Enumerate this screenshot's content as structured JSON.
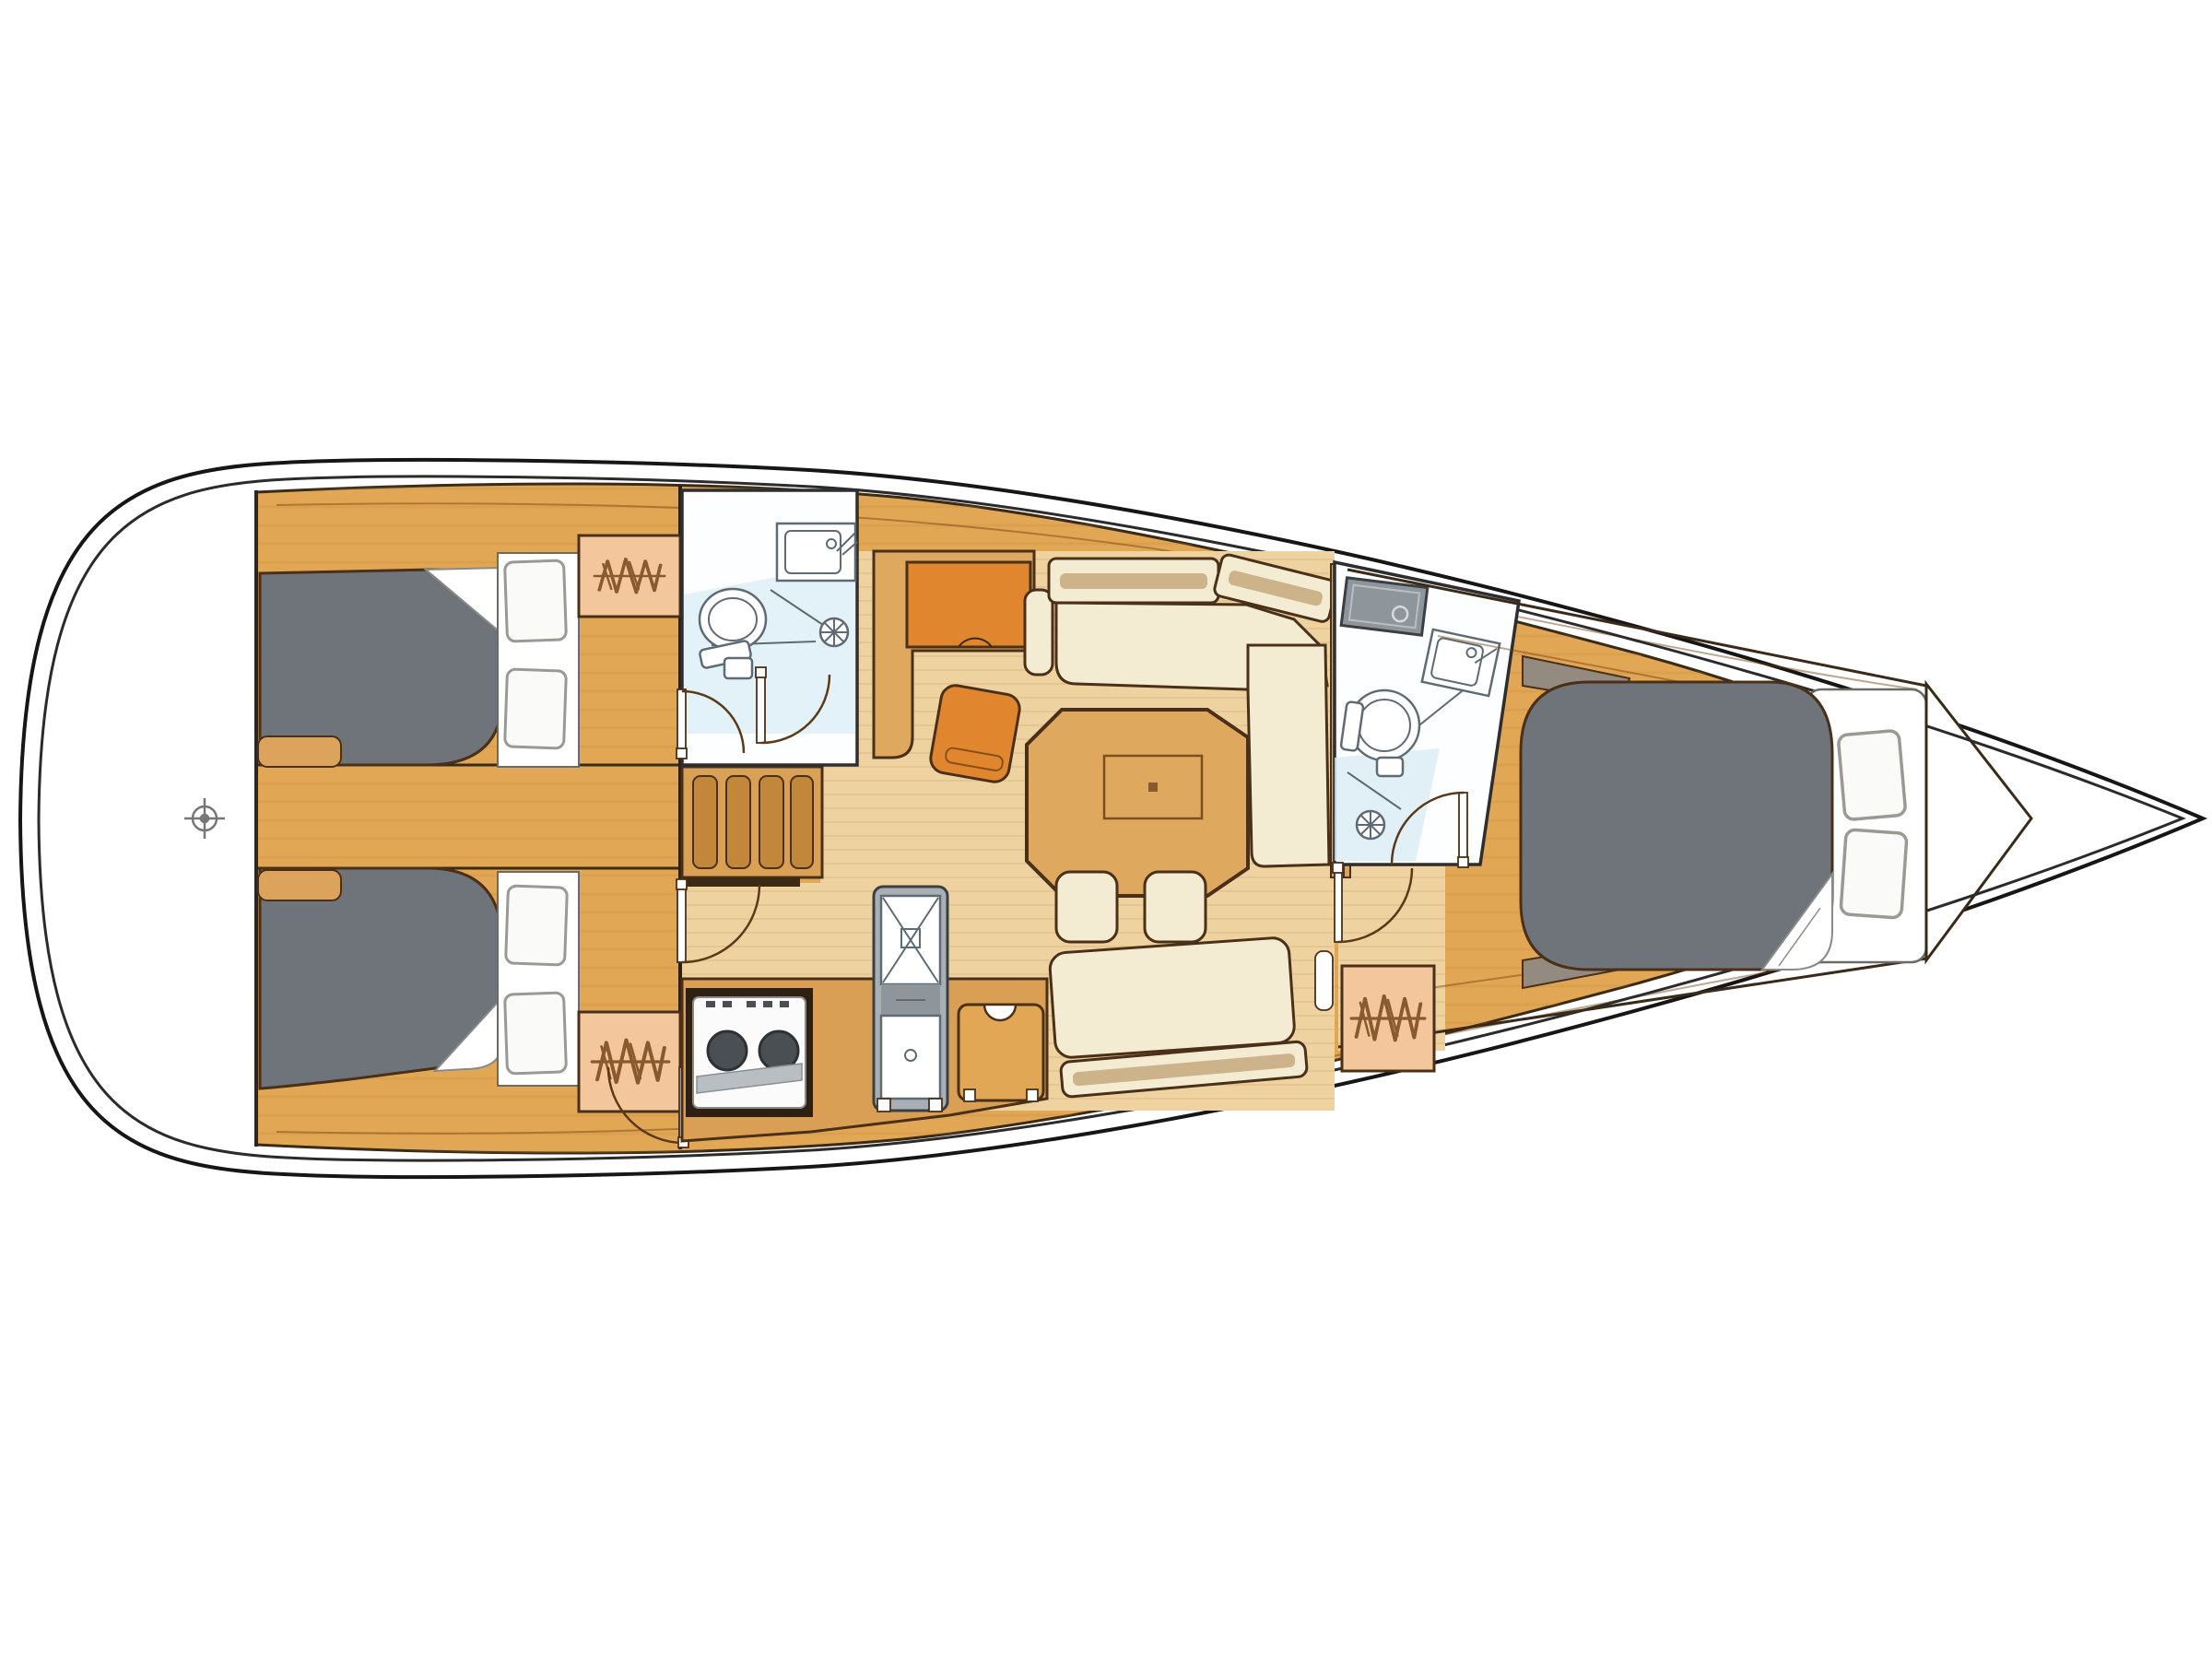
{
  "diagram": {
    "kind": "sailboat-interior-floor-plan",
    "view": "top-down",
    "orientation": "bow-right-stern-left"
  },
  "colors": {
    "background": "#ffffff",
    "hull_white": "#ffffff",
    "hull_line": "#161616",
    "deck_wood": "#e2a755",
    "deck_grain": "#b9853f",
    "floor_pale": "#eed2a0",
    "floor_grain": "#d8b37c",
    "counter_wood": "#d9a055",
    "stair_wood": "#d8a156",
    "tread_wood": "#c2873b",
    "rail_dark": "#3c2a15",
    "wood_tab": "#dba35c",
    "table_wood": "#dfa85f",
    "furniture_cream": "#f4ecd2",
    "cream_stripe": "#cdb389",
    "furniture_orange": "#e0862f",
    "berth_gray": "#6f747a",
    "berth_edge": "#43434a",
    "pillow_white": "#fafaf8",
    "pillow_edge": "#9a9a94",
    "sheet_white": "#ffffff",
    "locker_peach": "#f3c79b",
    "locker_symbol": "#8a5a2e",
    "head_white": "#fdfeff",
    "head_blue": "#d9ecf5",
    "sink_gray": "#a9b0b5",
    "counter_sink_gray": "#8e969c",
    "burner_dark": "#4a4f54",
    "stove_white": "#fbfbfb",
    "corner_pad_gray": "#938a80",
    "symbol_gray": "#777777"
  },
  "components": {
    "hull": "hull outline",
    "transom": "stern platform",
    "steering_mark": "wheel position mark",
    "aft_cabin_port": "aft double cabin (top)",
    "aft_cabin_starboard": "aft double cabin (bottom)",
    "companionway": "companionway stairs",
    "aft_head": "aft bathroom with toilet, sink and shower",
    "nav_station": "chart table with seat",
    "saloon": "saloon with L-settee, table and stools",
    "galley": "galley with stove, double sink and fridge",
    "fwd_head": "forward bathroom with toilet, sinks and shower",
    "fwd_cabin": "forward owner cabin with double berth",
    "hanging_lockers": "wardrobes (zigzag symbol)",
    "bow_locker": "anchor / bow locker"
  }
}
